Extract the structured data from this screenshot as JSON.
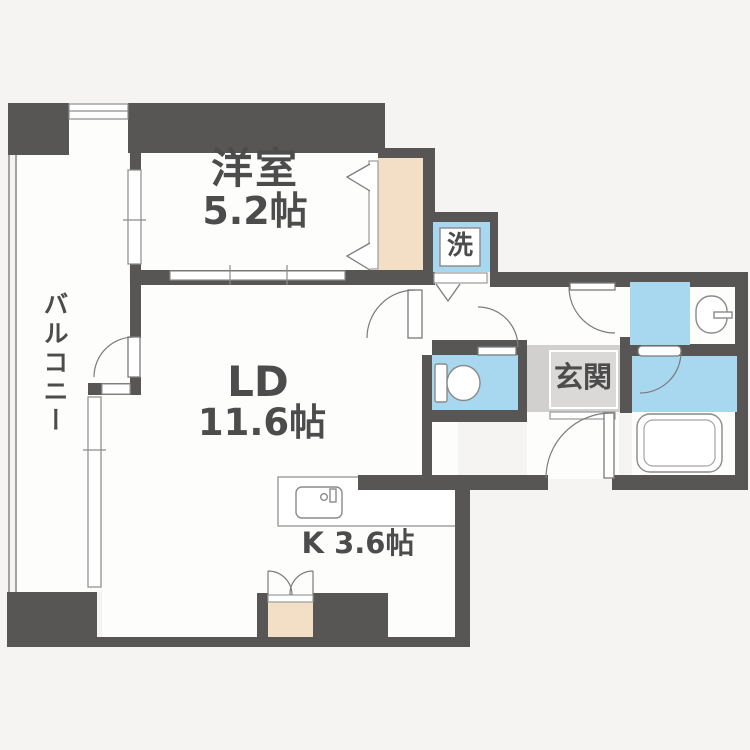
{
  "floorplan": {
    "title": "1LDK apartment floor plan",
    "rooms": {
      "western_room": {
        "name": "洋室",
        "size": "5.2帖"
      },
      "living_dining": {
        "name": "LD",
        "size": "11.6帖"
      },
      "kitchen": {
        "label": "K 3.6帖"
      },
      "entrance": {
        "label": "玄関"
      },
      "balcony": {
        "label": "バルコニー"
      },
      "washer": {
        "label": "洗"
      }
    },
    "colors": {
      "wall": "#585654",
      "water_area": "#a7d8f0",
      "closet": "#f2dfc5",
      "entrance_tile": "#d2d0ce",
      "background": "#f5f4f2",
      "floor": "#fdfdfc"
    }
  }
}
